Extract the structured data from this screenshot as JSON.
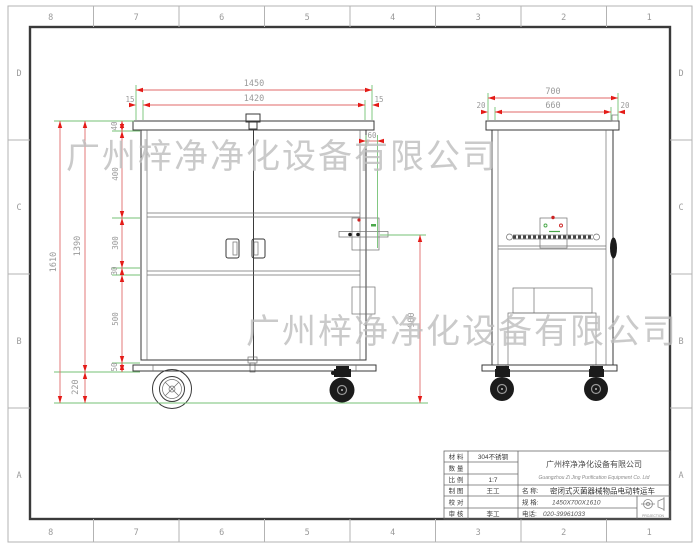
{
  "sheet": {
    "zone_columns": [
      "8",
      "7",
      "6",
      "5",
      "4",
      "3",
      "2",
      "1"
    ],
    "zone_rows": [
      "D",
      "C",
      "B",
      "A"
    ],
    "colors": {
      "dimension_line": "#e06a6a",
      "dimension_arrow": "#e41b17",
      "extension_line": "#74c274",
      "dimension_text": "#9a9a9a",
      "drawing_line": "#3a3a3a",
      "watermark": "#bdbdbd"
    }
  },
  "watermark": {
    "text": "广州梓净净化设备有限公司"
  },
  "front_view": {
    "dim_width_overall": "1450",
    "dim_width_inner": "1420",
    "dim_edge_left": "15",
    "dim_edge_right": "15",
    "dim_height_overall": "1610",
    "dim_height_body": "1390",
    "dim_height_wheel": "220",
    "dim_chain": [
      "40",
      "400",
      "300",
      "30",
      "500",
      "50"
    ],
    "dim_top_offset": "60",
    "dim_handle_height": "900"
  },
  "side_view": {
    "dim_width_overall": "700",
    "dim_width_inner": "660",
    "dim_edge_left": "20",
    "dim_edge_right": "20"
  },
  "title_block": {
    "material_label": "材 料",
    "material_value": "304不锈钢",
    "quantity_label": "数 量",
    "quantity_value": "",
    "scale_label": "比 例",
    "scale_value": "1:7",
    "draft_label": "制 图",
    "draft_value": "王工",
    "check_label": "校 对",
    "check_value": "",
    "audit_label": "审 核",
    "audit_value": "李工",
    "company_cn": "广州梓净净化设备有限公司",
    "company_en": "Guangzhou Zi Jing Purification Equipment Co. Ltd",
    "name_label": "名  称:",
    "name_value": "密闭式灭菌器械物品电动转运车",
    "spec_label": "规  格:",
    "spec_value": "1450X700X1610",
    "phone_label": "电话:",
    "phone_value": "020-39961033",
    "projection_label": "PROJECTION"
  }
}
